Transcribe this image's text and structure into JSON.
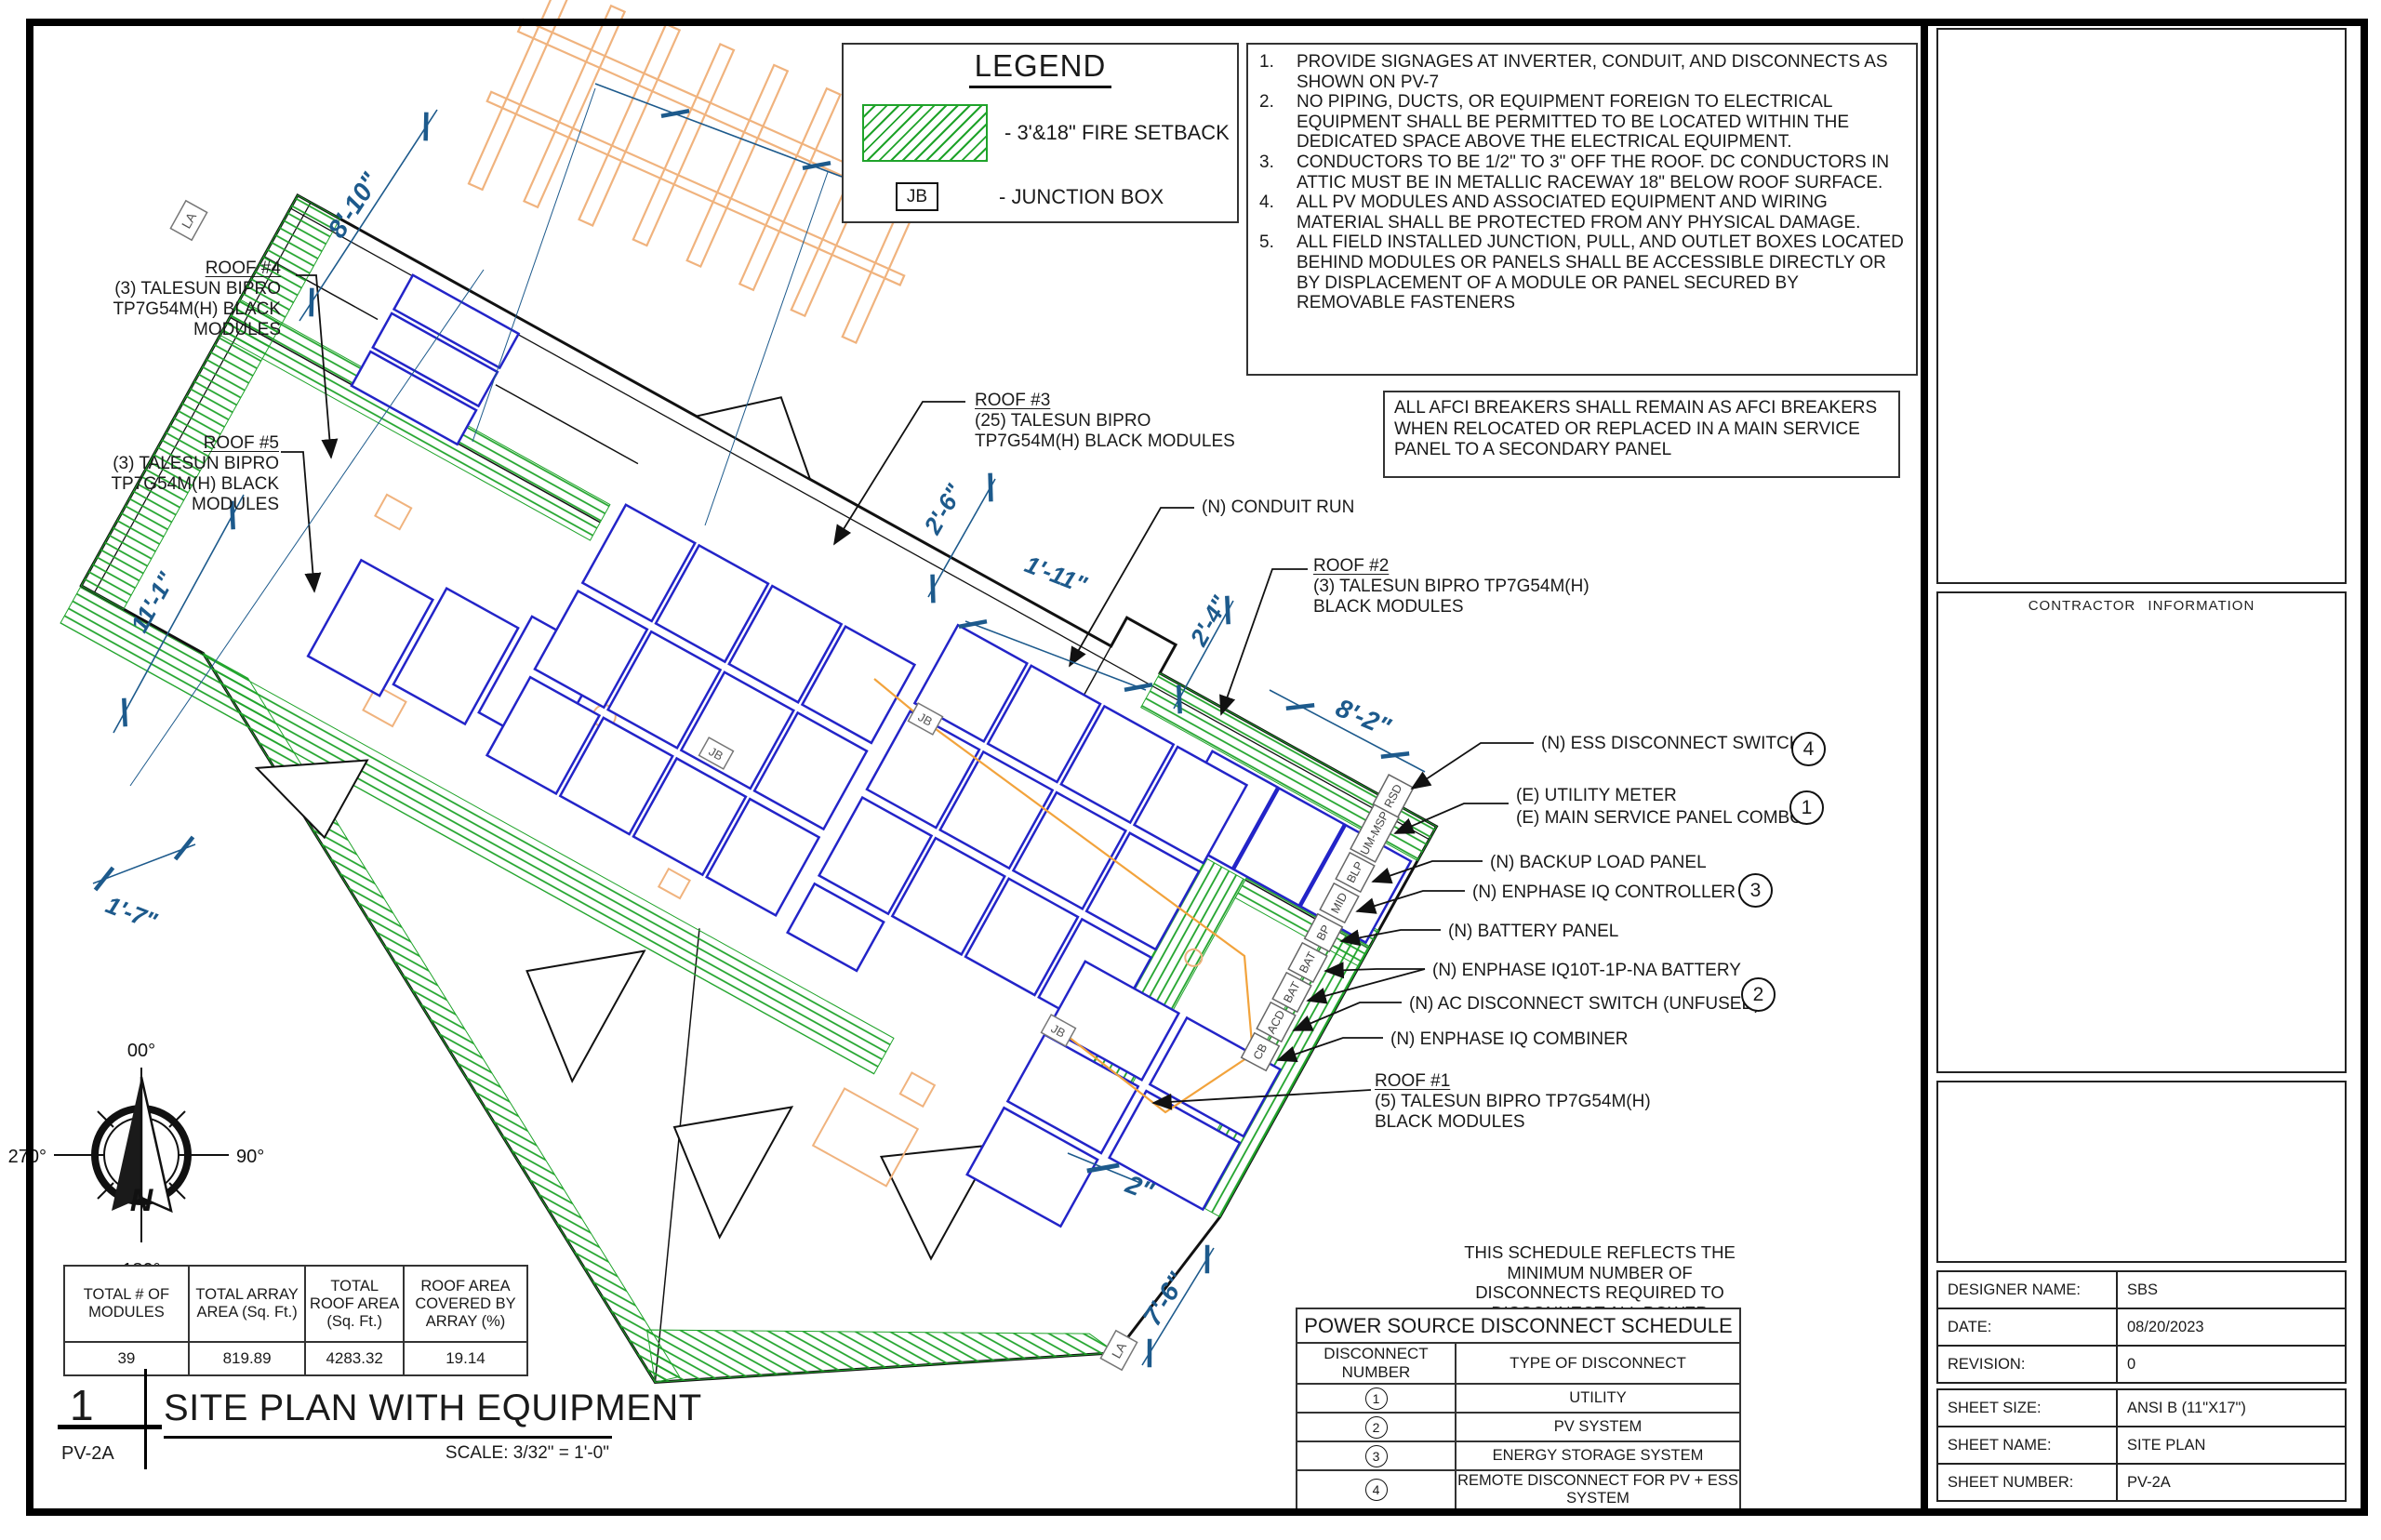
{
  "drawing": {
    "legend": {
      "title": "LEGEND",
      "fire_setback_label": "- 3'&18\" FIRE SETBACK",
      "jb_symbol": "JB",
      "jb_label": "- JUNCTION BOX"
    },
    "notes": [
      {
        "num": "1.",
        "text": "PROVIDE SIGNAGES AT INVERTER, CONDUIT, AND DISCONNECTS AS SHOWN ON PV-7"
      },
      {
        "num": "2.",
        "text": "NO PIPING, DUCTS, OR EQUIPMENT FOREIGN TO ELECTRICAL EQUIPMENT SHALL BE PERMITTED TO BE LOCATED WITHIN THE DEDICATED SPACE ABOVE THE ELECTRICAL EQUIPMENT."
      },
      {
        "num": "3.",
        "text": "CONDUCTORS TO BE 1/2\" TO 3\" OFF THE ROOF. DC CONDUCTORS IN ATTIC MUST BE IN METALLIC RACEWAY 18\" BELOW ROOF SURFACE."
      },
      {
        "num": "4.",
        "text": "ALL PV MODULES AND ASSOCIATED EQUIPMENT AND WIRING MATERIAL SHALL BE PROTECTED FROM ANY PHYSICAL DAMAGE."
      },
      {
        "num": "5.",
        "text": "ALL FIELD INSTALLED JUNCTION, PULL, AND OUTLET BOXES LOCATED BEHIND MODULES OR PANELS SHALL BE ACCESSIBLE DIRECTLY OR BY DISPLACEMENT OF A MODULE OR PANEL SECURED BY REMOVABLE FASTENERS"
      }
    ],
    "afci_note": "ALL AFCI BREAKERS SHALL REMAIN AS AFCI BREAKERS WHEN RELOCATED OR REPLACED IN A MAIN SERVICE PANEL TO A SECONDARY PANEL",
    "roofs": {
      "roof1": {
        "title": "ROOF #1",
        "line1": "(5) TALESUN BIPRO TP7G54M(H)",
        "line2": "BLACK MODULES"
      },
      "roof2": {
        "title": "ROOF #2",
        "line1": "(3) TALESUN BIPRO TP7G54M(H)",
        "line2": "BLACK MODULES"
      },
      "roof3": {
        "title": "ROOF #3",
        "line1": "(25) TALESUN BIPRO",
        "line2": "TP7G54M(H) BLACK MODULES"
      },
      "roof4": {
        "title": "ROOF #4",
        "line1": "(3) TALESUN BIPRO",
        "line2": "TP7G54M(H) BLACK",
        "line3": "MODULES"
      },
      "roof5": {
        "title": "ROOF #5",
        "line1": "(3) TALESUN BIPRO",
        "line2": "TP7G54M(H) BLACK",
        "line3": "MODULES"
      }
    },
    "callouts": {
      "conduit": "(N) CONDUIT RUN",
      "ess": "(N) ESS DISCONNECT SWITCH",
      "ess_num": "4",
      "utility_line1": "(E) UTILITY METER",
      "utility_line2": "(E) MAIN SERVICE PANEL COMBO",
      "utility_num": "1",
      "backup": "(N) BACKUP LOAD PANEL",
      "controller": "(N) ENPHASE IQ CONTROLLER 2",
      "controller_num": "3",
      "battery_panel": "(N) BATTERY PANEL",
      "battery": "(N) ENPHASE IQ10T-1P-NA BATTERY",
      "ac_disconnect": "(N) AC DISCONNECT SWITCH (UNFUSED)",
      "ac_disconnect_num": "2",
      "combiner": "(N) ENPHASE IQ COMBINER"
    },
    "equipment_tags": [
      "RSD",
      "UM-MSP",
      "BLP",
      "MID",
      "BP",
      "BAT",
      "BAT",
      "ACD",
      "CB"
    ],
    "markers": {
      "la": "LA",
      "jb": "JB"
    },
    "dimensions": {
      "d1": "4'-1\"",
      "d2": "8'-10\"",
      "d3": "2'-6\"",
      "d4": "1'-11\"",
      "d5": "2'-4\"",
      "d6": "8'-2\"",
      "d7": "11'-1\"",
      "d8": "1'-7\"",
      "d9": "2\"",
      "d10": "7'-6\""
    },
    "compass": {
      "n": "N",
      "top": "00°",
      "right": "90°",
      "bottom": "180°",
      "left": "270°"
    }
  },
  "summary_table": {
    "headers": [
      "TOTAL # OF MODULES",
      "TOTAL ARRAY AREA (Sq. Ft.)",
      "TOTAL ROOF AREA (Sq. Ft.)",
      "ROOF AREA COVERED BY ARRAY (%)"
    ],
    "values": [
      "39",
      "819.89",
      "4283.32",
      "19.14"
    ]
  },
  "schedule": {
    "note_line1": "THIS SCHEDULE REFLECTS THE MINIMUM NUMBER OF",
    "note_line2": "DISCONNECTS REQUIRED TO DISCONNECT ALL POWER",
    "note_line3": "SOURCES FROM THE CIRCUITRY OF THE STRUCTURE.",
    "title": "POWER SOURCE DISCONNECT SCHEDULE",
    "col1": "DISCONNECT NUMBER",
    "col2": "TYPE OF DISCONNECT",
    "rows": [
      {
        "num": "1",
        "type": "UTILITY"
      },
      {
        "num": "2",
        "type": "PV SYSTEM"
      },
      {
        "num": "3",
        "type": "ENERGY STORAGE SYSTEM"
      },
      {
        "num": "4",
        "type": "REMOTE DISCONNECT FOR PV + ESS SYSTEM"
      }
    ]
  },
  "title_block": {
    "sheet_num": "1",
    "title": "SITE PLAN WITH EQUIPMENT",
    "sheet_code": "PV-2A",
    "scale": "SCALE: 3/32\" = 1'-0\""
  },
  "title_column": {
    "contractor_header": "CONTRACTOR INFORMATION",
    "rows": [
      {
        "label": "DESIGNER NAME:",
        "value": "SBS"
      },
      {
        "label": "DATE:",
        "value": "08/20/2023"
      },
      {
        "label": "REVISION:",
        "value": "0"
      },
      {
        "label": "SHEET SIZE:",
        "value": "ANSI B (11\"X17\")"
      },
      {
        "label": "SHEET NAME:",
        "value": "SITE PLAN"
      },
      {
        "label": "SHEET NUMBER:",
        "value": "PV-2A"
      }
    ]
  },
  "colors": {
    "setback_green": "#1fa32a",
    "module_blue": "#2324c8",
    "dimension_blue": "#1d5a8c",
    "conduit_orange": "#f2a33c",
    "pergola_orange": "#f0b37e"
  }
}
